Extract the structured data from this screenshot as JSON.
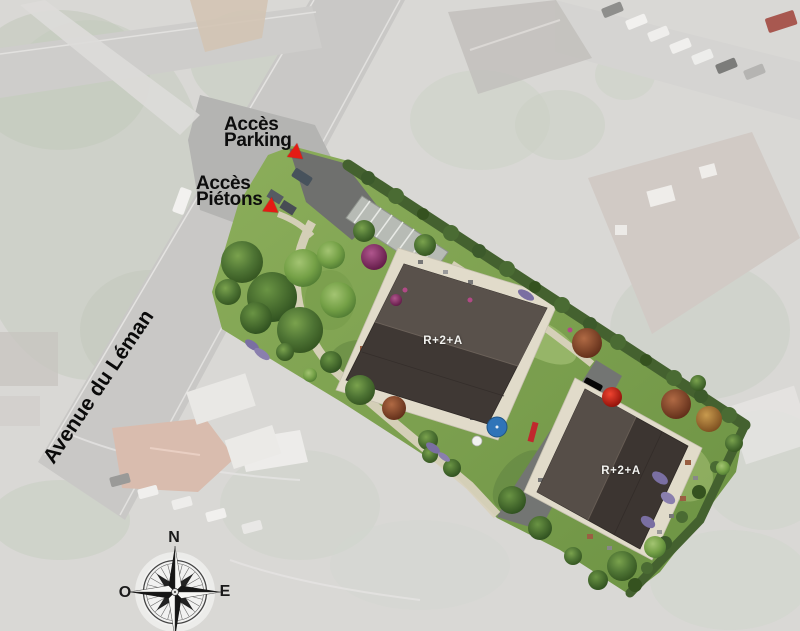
{
  "map": {
    "markers": {
      "parking": {
        "label": "Accès\nParking"
      },
      "pietons": {
        "label": "Accès\nPiétons"
      }
    },
    "street": {
      "name": "Avenue du Léman"
    },
    "buildings": [
      {
        "label": "R+2+A"
      },
      {
        "label": "R+2+A"
      }
    ],
    "compass": {
      "north": "N",
      "west": "O",
      "east": "E"
    },
    "colors": {
      "marker_red": "#e41b14",
      "grass": "#7ca24f",
      "hedge": "#44612f",
      "roof_dark": "#3f3834",
      "roof_light": "#59514b",
      "terrace": "#e1dbca",
      "road": "#737573",
      "aerial_background": "#d9d8d5",
      "parasol_blue": "#2f74b8",
      "parasol_red": "#c41e1e"
    }
  }
}
